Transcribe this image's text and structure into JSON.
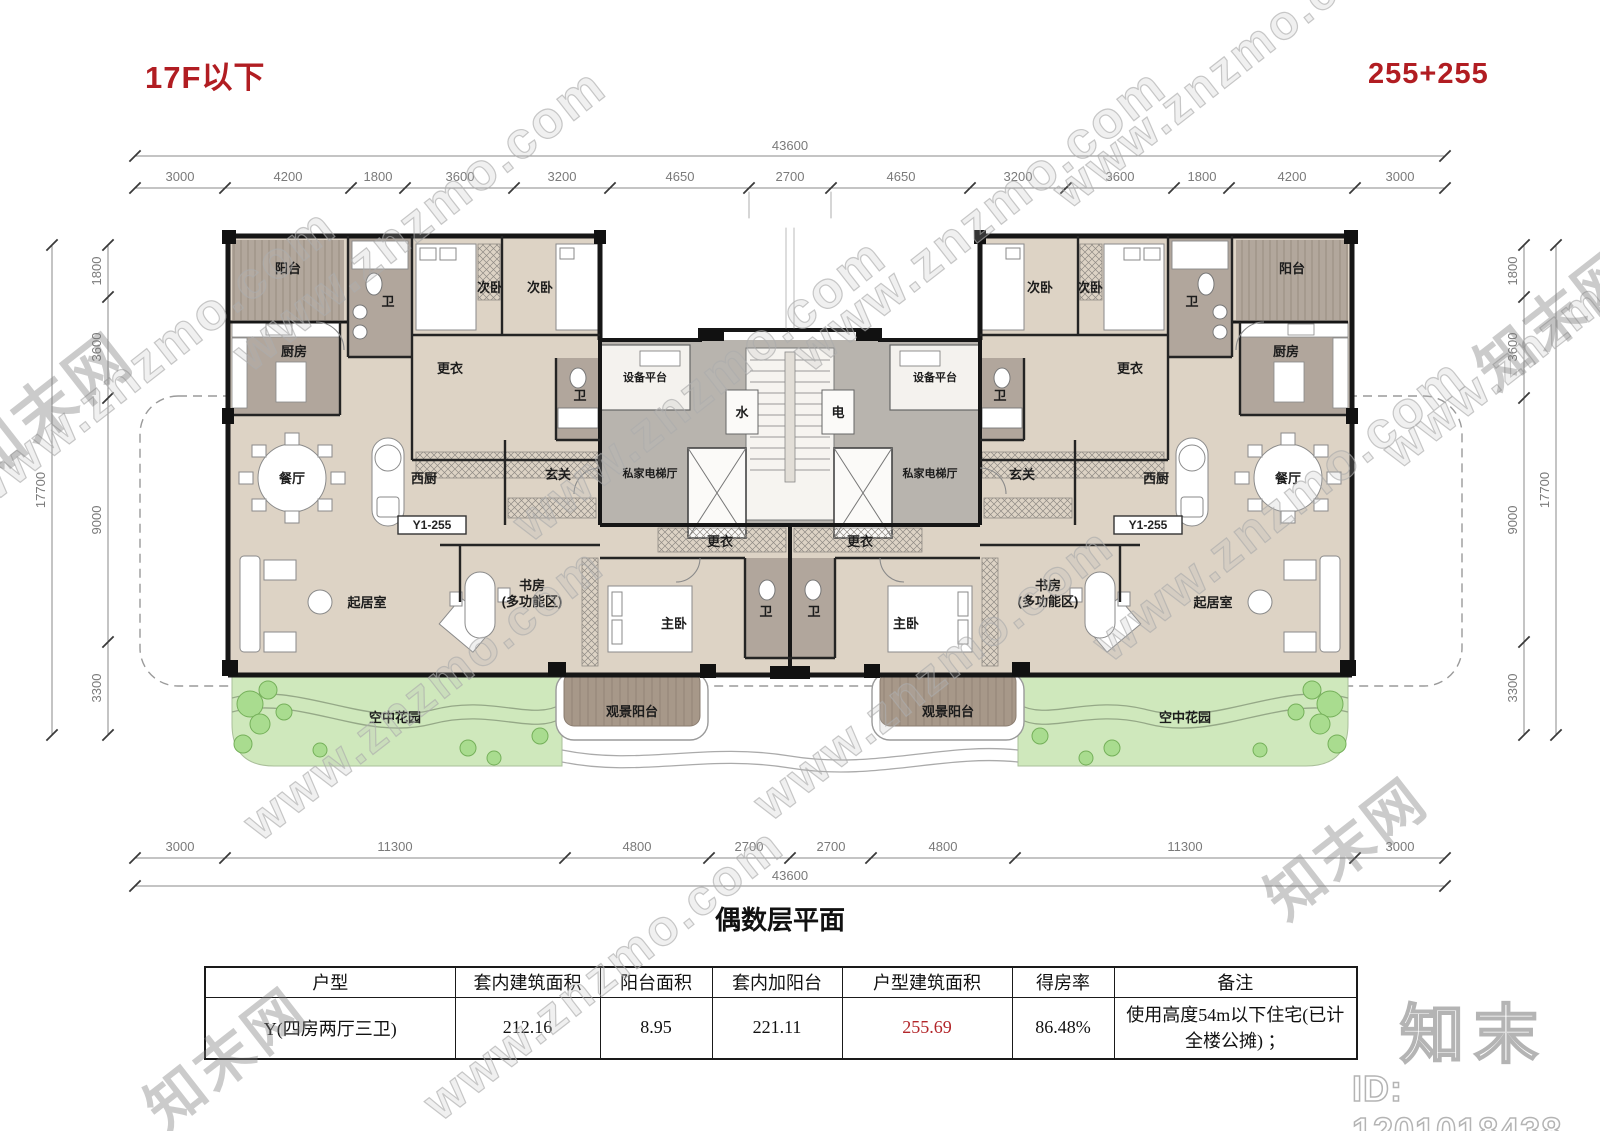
{
  "header": {
    "floor_label": "17F以下",
    "capacity_label": "255+255"
  },
  "plan": {
    "unit_code": "Y1-255",
    "rooms": {
      "balcony": "阳台",
      "kitchen": "厨房",
      "bath": "卫",
      "bedroom": "次卧",
      "dressing": "更衣",
      "equipment": "设备平台",
      "water": "水",
      "electricity": "电",
      "foyer": "玄关",
      "elevator_hall": "私家电梯厅",
      "dining": "餐厅",
      "west_kitchen": "西厨",
      "living": "起居室",
      "study_line1": "书房",
      "study_line2": "(多功能区)",
      "master": "主卧",
      "view_balcony": "观景阳台",
      "sky_garden": "空中花园"
    },
    "dims": {
      "total": "43600",
      "side_total": "17700",
      "top": [
        "3000",
        "4200",
        "1800",
        "3600",
        "3200",
        "4650",
        "2700",
        "4650",
        "3200",
        "3600",
        "1800",
        "4200",
        "3000"
      ],
      "bottom": [
        "3000",
        "11300",
        "4800",
        "2700",
        "2700",
        "4800",
        "11300",
        "3000"
      ],
      "side": [
        "1800",
        "3600",
        "9000",
        "3300"
      ]
    }
  },
  "table": {
    "title": "偶数层平面",
    "headers": [
      "户型",
      "套内建筑面积",
      "阳台面积",
      "套内加阳台",
      "户型建筑面积",
      "得房率",
      "备注"
    ],
    "row": {
      "unit_type": "Y(四房两厅三卫)",
      "inner_area": "212.16",
      "balcony_area": "8.95",
      "inner_plus_balcony": "221.11",
      "gross_area": "255.69",
      "efficiency_rate": "86.48%",
      "remark": "使用高度54m以下住宅(已计全楼公摊) ；"
    }
  },
  "watermark": {
    "site_url": "www.znzmo.com",
    "brand": "知末网",
    "logo": "知末",
    "image_id": "ID: 1201018438"
  },
  "colors": {
    "accent_red": "#b11d22",
    "value_red": "#b3262a",
    "floor_beige": "#ddd3c5",
    "floor_mauve": "#b1a69c",
    "core_gray": "#b8b4ae",
    "garden_green": "#cfe8bc",
    "balcony_mauve": "#a79889"
  }
}
